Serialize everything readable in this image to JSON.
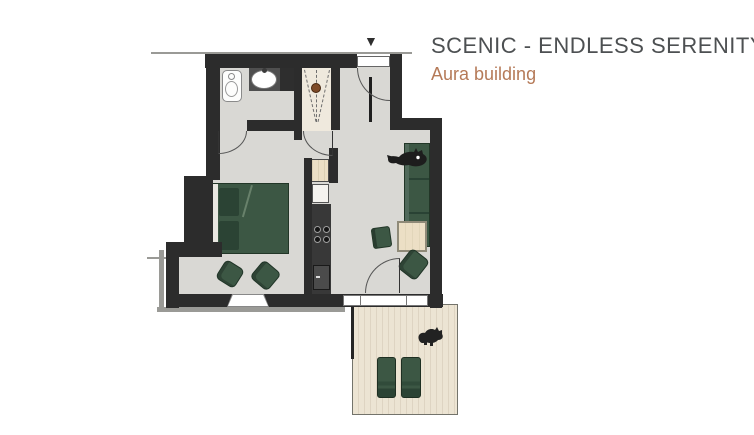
{
  "header": {
    "title": "SCENIC - ENDLESS SERENITY +",
    "subtitle": "Aura building"
  },
  "icons": {
    "entrance_marker": "▼"
  },
  "colors": {
    "title_text": "#4d5052",
    "subtitle_text": "#b57a58",
    "wall": "#2c2c2c",
    "floor": "#d9d8d4",
    "closet_floor": "#efe9dd",
    "deck": "#ece4d3",
    "deck_line": "#ded4c2",
    "green": "#3c5744",
    "green_dark": "#2b4334",
    "wood": "#ecdfc5",
    "counter": "#383838",
    "outline": "#9a9a96",
    "arc": "#555555"
  }
}
